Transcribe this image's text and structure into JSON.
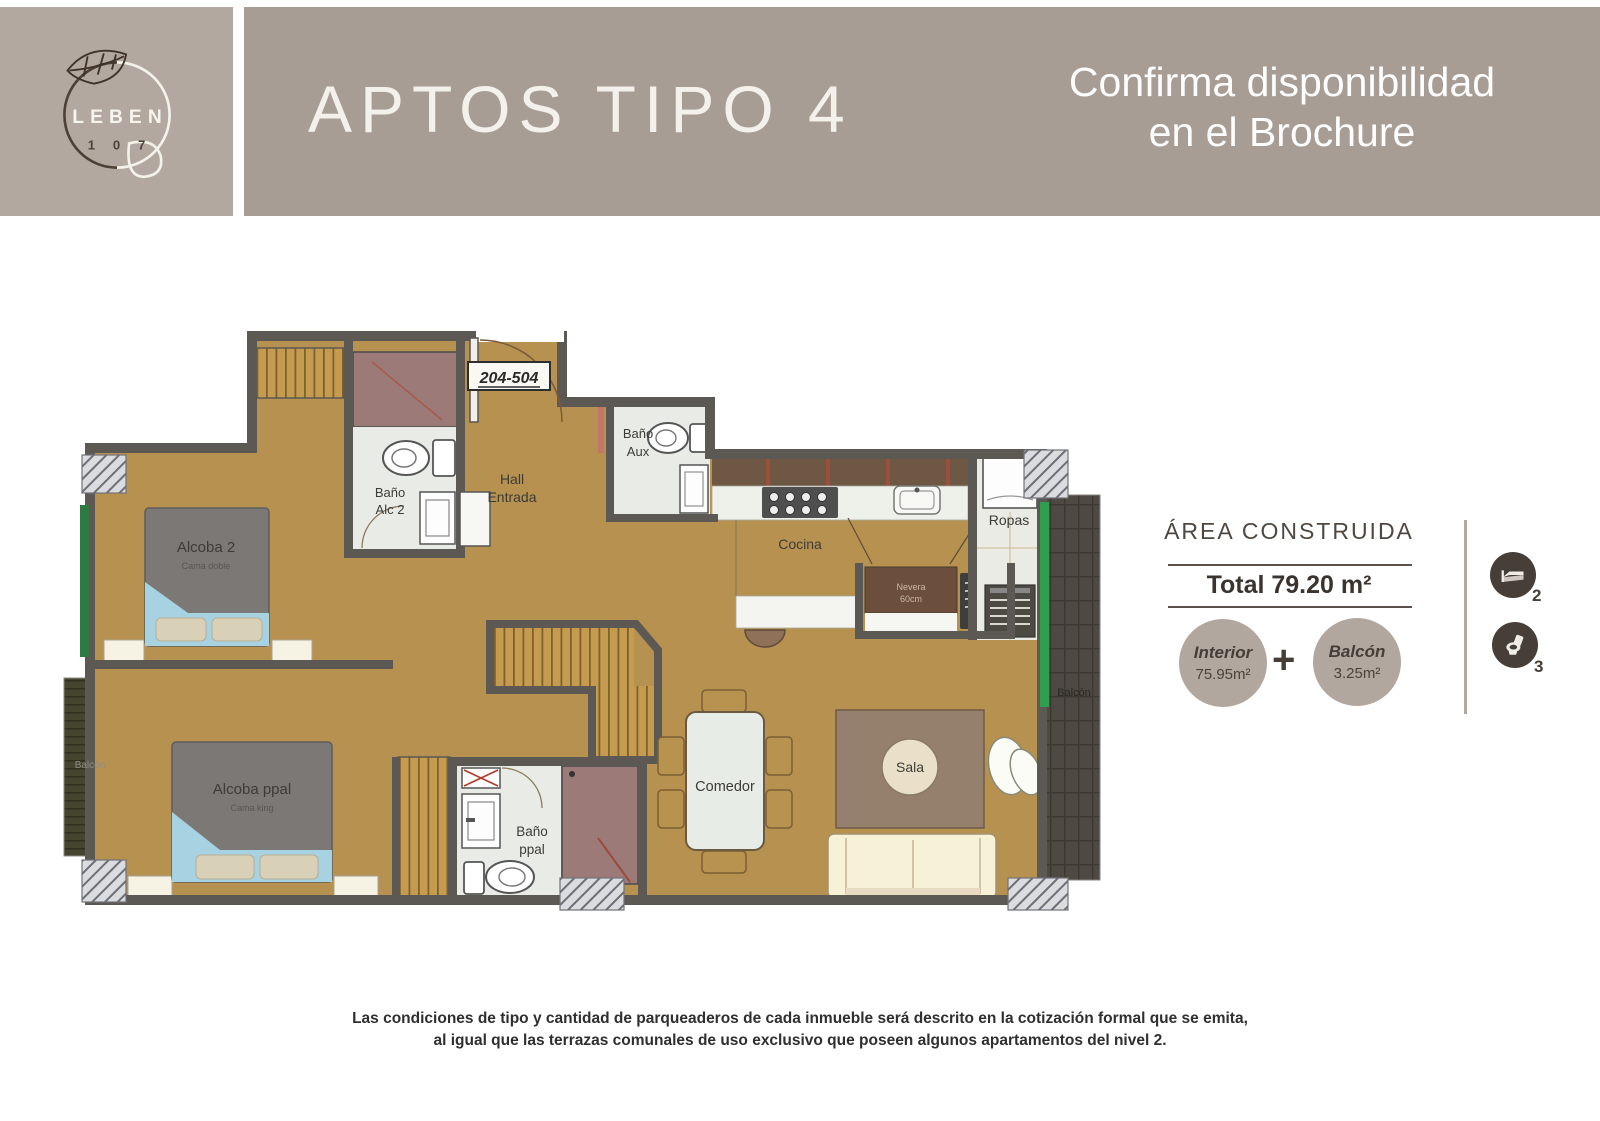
{
  "header": {
    "brand_name": "LEBEN",
    "brand_number": "1 0 7",
    "title": "APTOS TIPO 4",
    "availability_line1": "Confirma disponibilidad",
    "availability_line2": "en el Brochure"
  },
  "plan": {
    "unit_range": "204-504",
    "labels": {
      "alcoba2": "Alcoba 2",
      "alcoba2_sub": "Cama doble",
      "bano_alc2_l1": "Baño",
      "bano_alc2_l2": "Alc 2",
      "hall_l1": "Hall",
      "hall_l2": "Entrada",
      "bano_aux_l1": "Baño",
      "bano_aux_l2": "Aux",
      "cocina": "Cocina",
      "ropas": "Ropas",
      "nevera_l1": "Nevera",
      "nevera_l2": "60cm",
      "alcoba_ppal": "Alcoba ppal",
      "alcoba_ppal_sub": "Cama king",
      "bano_ppal_l1": "Baño",
      "bano_ppal_l2": "ppal",
      "comedor": "Comedor",
      "sala": "Sala",
      "balcon_left": "Balcón",
      "balcon_right": "Balcón"
    }
  },
  "area": {
    "title": "ÁREA CONSTRUIDA",
    "total": "Total 79.20 m²",
    "interior_label": "Interior",
    "interior_value": "75.95m²",
    "plus": "+",
    "balcon_label": "Balcón",
    "balcon_value": "3.25m²",
    "bedrooms": "2",
    "bathrooms": "3"
  },
  "disclaimer": {
    "line1": "Las condiciones de tipo y cantidad de parqueaderos de cada inmueble será descrito en la cotización formal que se emita,",
    "line2": "al igual que las terrazas comunales de uso exclusivo que poseen algunos apartamentos del nivel 2."
  },
  "colors": {
    "header_left": "#b2a8a0",
    "header_right": "#a79d95",
    "floor_tan": "#b69150",
    "wall_gray": "#5c5853",
    "bathroom_floor": "#e9ece6",
    "shower_mauve": "#9b7a78",
    "closet_stripe": "#c59b50",
    "balcony_green": "#2f9e4f",
    "panel_circle": "#b1a79e",
    "stat_icon_bg": "#463e37"
  }
}
